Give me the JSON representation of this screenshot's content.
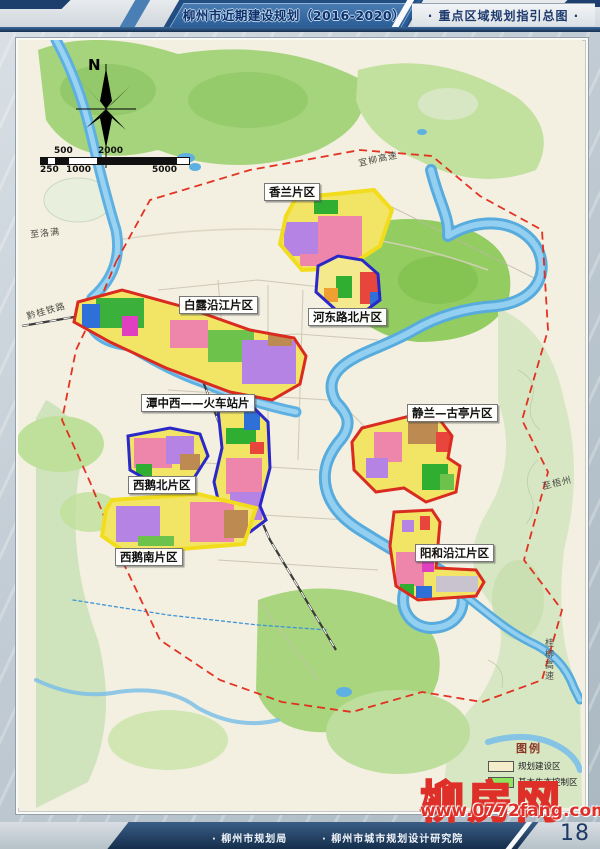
{
  "header": {
    "title": "柳州市近期建设规划（2016-2020）",
    "subtitle": "· 重点区域规划指引总图 ·"
  },
  "map": {
    "compass_label": "N",
    "scalebar": {
      "top_labels": [
        "500",
        "2000"
      ],
      "bottom_labels": [
        "250",
        "1000",
        "5000"
      ]
    },
    "districts": [
      {
        "label": "香兰片区",
        "outline_color": "#f2dc1e"
      },
      {
        "label": "白露沿江片区",
        "outline_color": "#d92b20"
      },
      {
        "label": "河东路北片区",
        "outline_color": "#2a28c8"
      },
      {
        "label": "潭中西——火车站片",
        "outline_color": "#2a28c8"
      },
      {
        "label": "静兰—古亭片区",
        "outline_color": "#d92b20"
      },
      {
        "label": "西鹅北片区",
        "outline_color": "#2a28c8"
      },
      {
        "label": "西鹅南片区",
        "outline_color": "#f2dc1e"
      },
      {
        "label": "阳和沿江片区",
        "outline_color": "#d92b20"
      }
    ],
    "place_labels": [
      "至洛满",
      "黔桂铁路",
      "宜柳高速",
      "至梧州",
      "桂柳高速"
    ],
    "legend": {
      "title": "图例",
      "items": [
        {
          "label": "规划建设区",
          "color": "#f5ecca"
        },
        {
          "label": "基本生态控制区",
          "color": "#8ee45e"
        }
      ]
    }
  },
  "watermark": {
    "brand": "柳房网",
    "url": "www.0772fang.com"
  },
  "footer": {
    "credit1": "· 柳州市规划局",
    "credit2": "· 柳州市城市规划设计研究院",
    "page": "18"
  },
  "colors": {
    "header_navy": "#1d3a6e",
    "band_blue": "#2a5c96",
    "boundary_red": "#e22818",
    "river_blue": "#58abdd",
    "vegetation_green": "#a6d47c",
    "map_base": "#f3f0e1"
  }
}
